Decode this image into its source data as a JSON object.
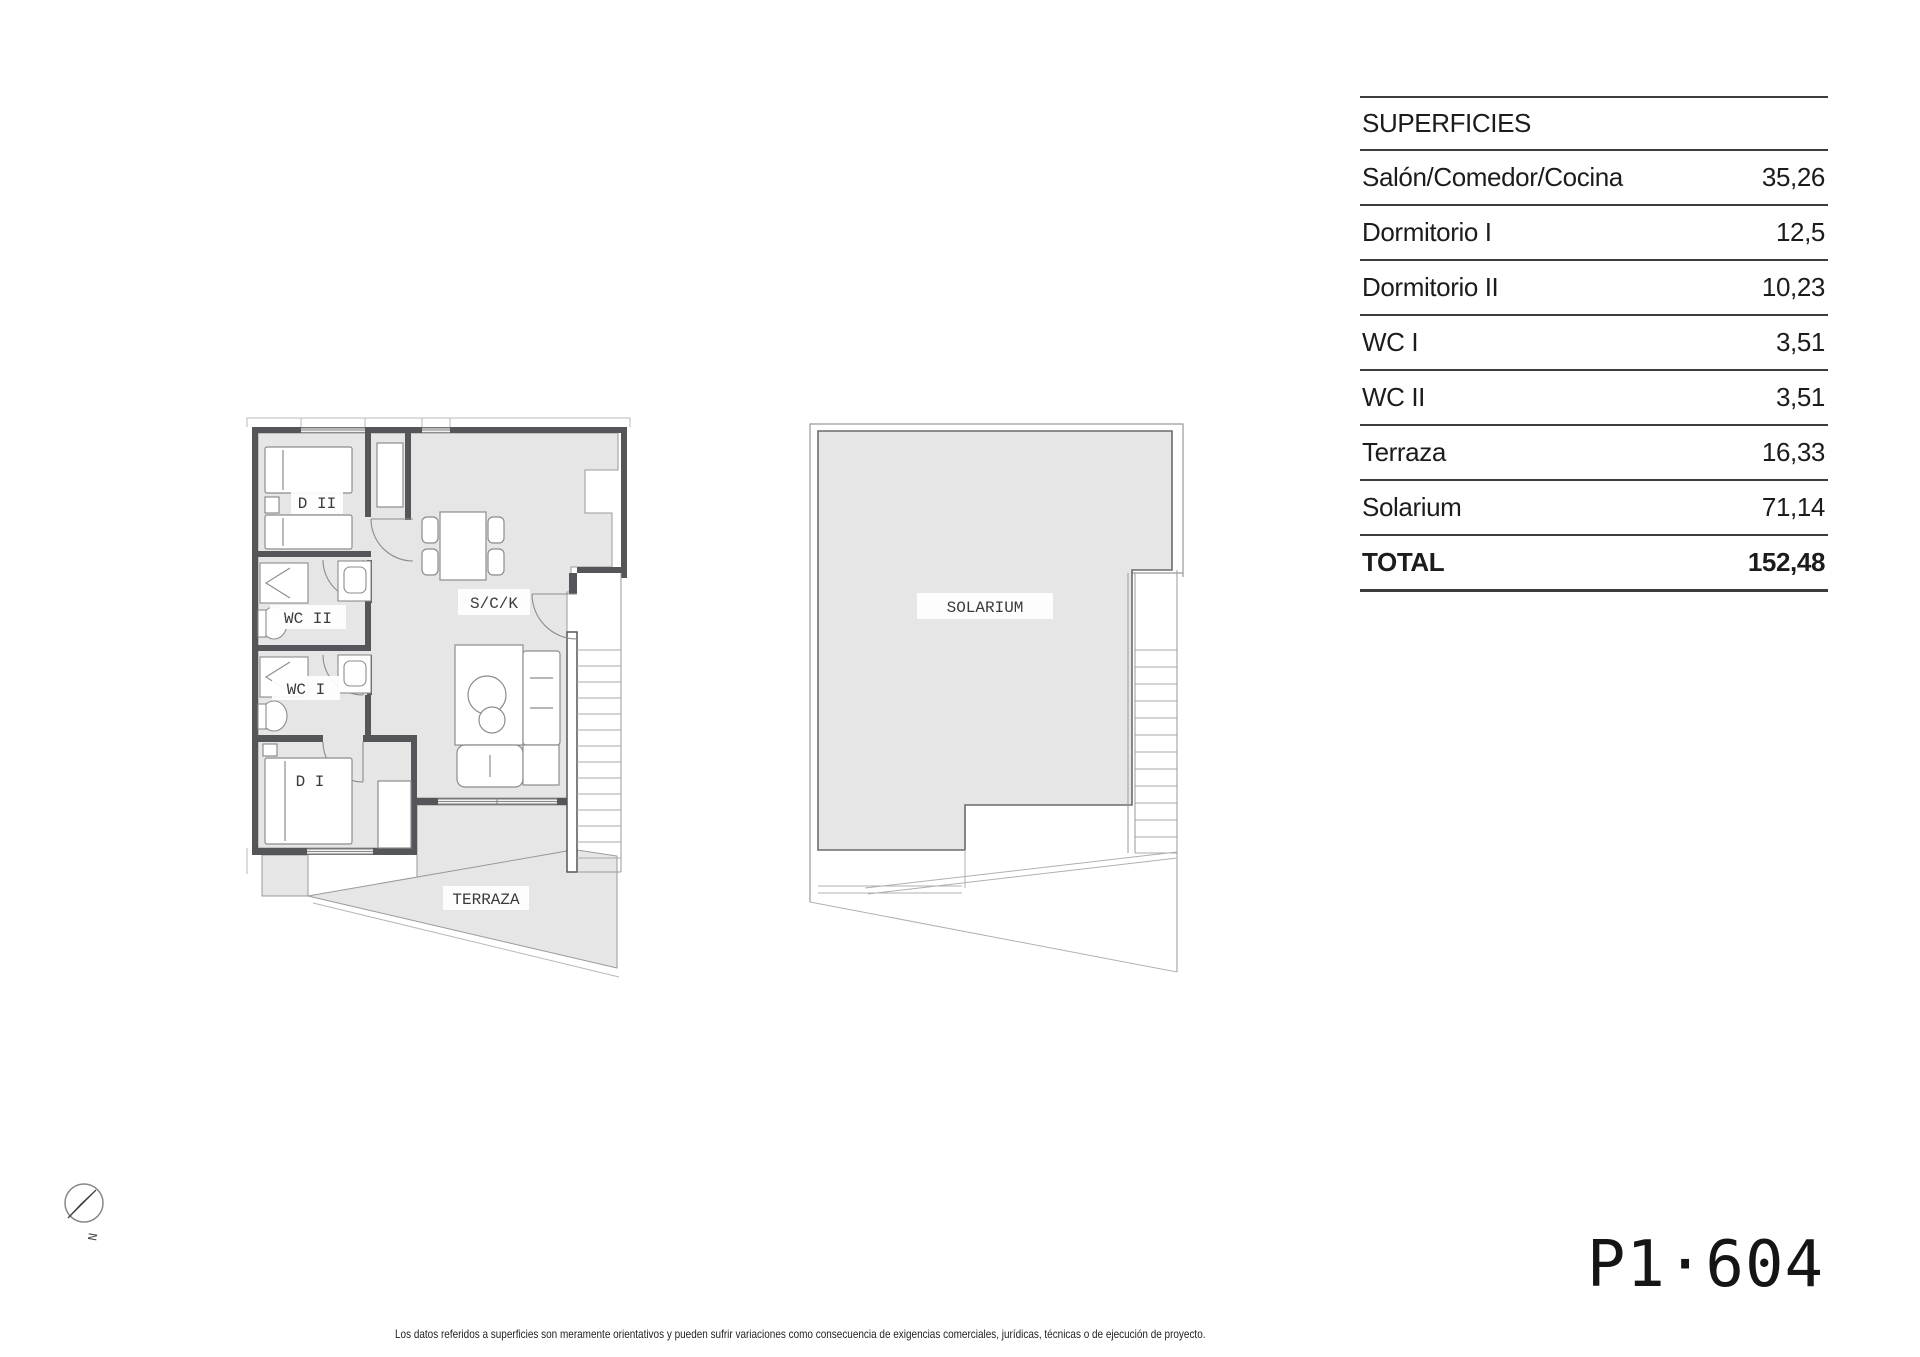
{
  "document": {
    "surfaces_table": {
      "header": "SUPERFICIES",
      "rows": [
        {
          "label": "Salón/Comedor/Cocina",
          "value": "35,26"
        },
        {
          "label": "Dormitorio I",
          "value": "12,5"
        },
        {
          "label": "Dormitorio II",
          "value": "10,23"
        },
        {
          "label": "WC I",
          "value": "3,51"
        },
        {
          "label": "WC II",
          "value": "3,51"
        },
        {
          "label": "Terraza",
          "value": "16,33"
        },
        {
          "label": "Solarium",
          "value": "71,14"
        }
      ],
      "total_row": {
        "label": "TOTAL",
        "value": "152,48"
      }
    },
    "floor_plan": {
      "labels": {
        "dormitorio2": "D II",
        "wc2": "WC II",
        "wc1": "WC I",
        "dormitorio1": "D I",
        "salon_cocina": "S/C/K",
        "terraza": "TERRAZA"
      }
    },
    "solarium_plan": {
      "label": "SOLARIUM"
    },
    "compass": {
      "north": "N"
    },
    "unit_code": "P1·604",
    "disclaimer": "Los datos referidos a superficies son meramente orientativos y pueden sufrir variaciones como consecuencia de exigencias comerciales, jurídicas, técnicas o de ejecución de proyecto."
  },
  "colors": {
    "floor_fill": "#e6e6e7",
    "wall": "#55565a",
    "thin_line": "#9a9a9a",
    "furniture_line": "#8c8c8c",
    "table_line": "#3c3c3c",
    "text": "#1c1c1c"
  }
}
